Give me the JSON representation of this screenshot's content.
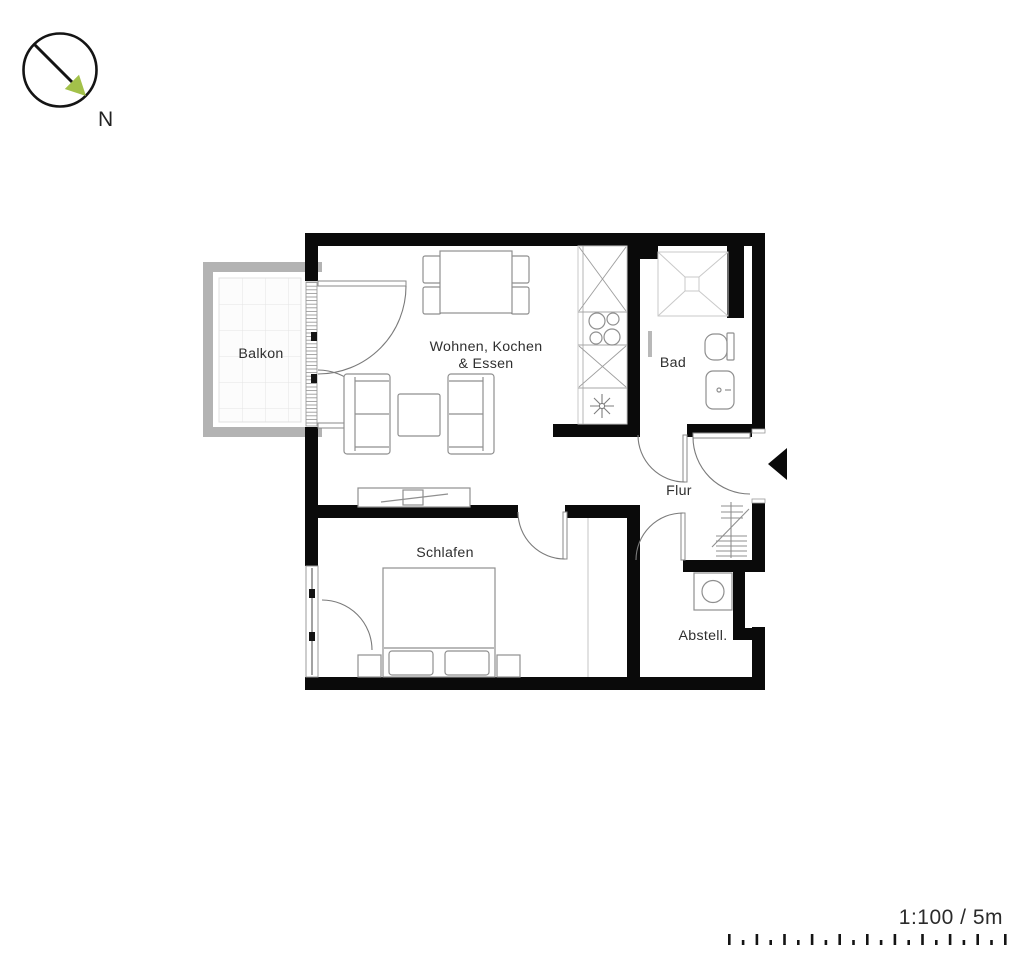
{
  "compass": {
    "label": "N"
  },
  "labels": {
    "balkon": "Balkon",
    "wohnen_line1": "Wohnen, Kochen",
    "wohnen_line2": "& Essen",
    "bad": "Bad",
    "flur": "Flur",
    "schlafen": "Schlafen",
    "abstell": "Abstell."
  },
  "scale": {
    "label": "1:100 / 5m",
    "tick_count": 21
  },
  "icons": {
    "compass": "north-compass-icon",
    "entrance": "entrance-arrow-icon",
    "sink": "kitchen-sink-icon",
    "cooktop": "cooktop-burners-icon",
    "shower": "shower-icon",
    "toilet": "toilet-icon",
    "washbasin": "washbasin-icon",
    "washer": "washing-machine-icon",
    "wardrobe": "coat-rack-icon",
    "tv": "tv-sideboard-icon"
  },
  "colors": {
    "wall": "#0a0a0a",
    "furniture_stroke": "#8f8f8f",
    "light_stroke": "#c9c9c9",
    "balcony_wall": "#b3b3b3",
    "balcony_grid": "#e4e4e4",
    "compass_arrow": "#a3c14a",
    "text": "#2f2f2f"
  }
}
